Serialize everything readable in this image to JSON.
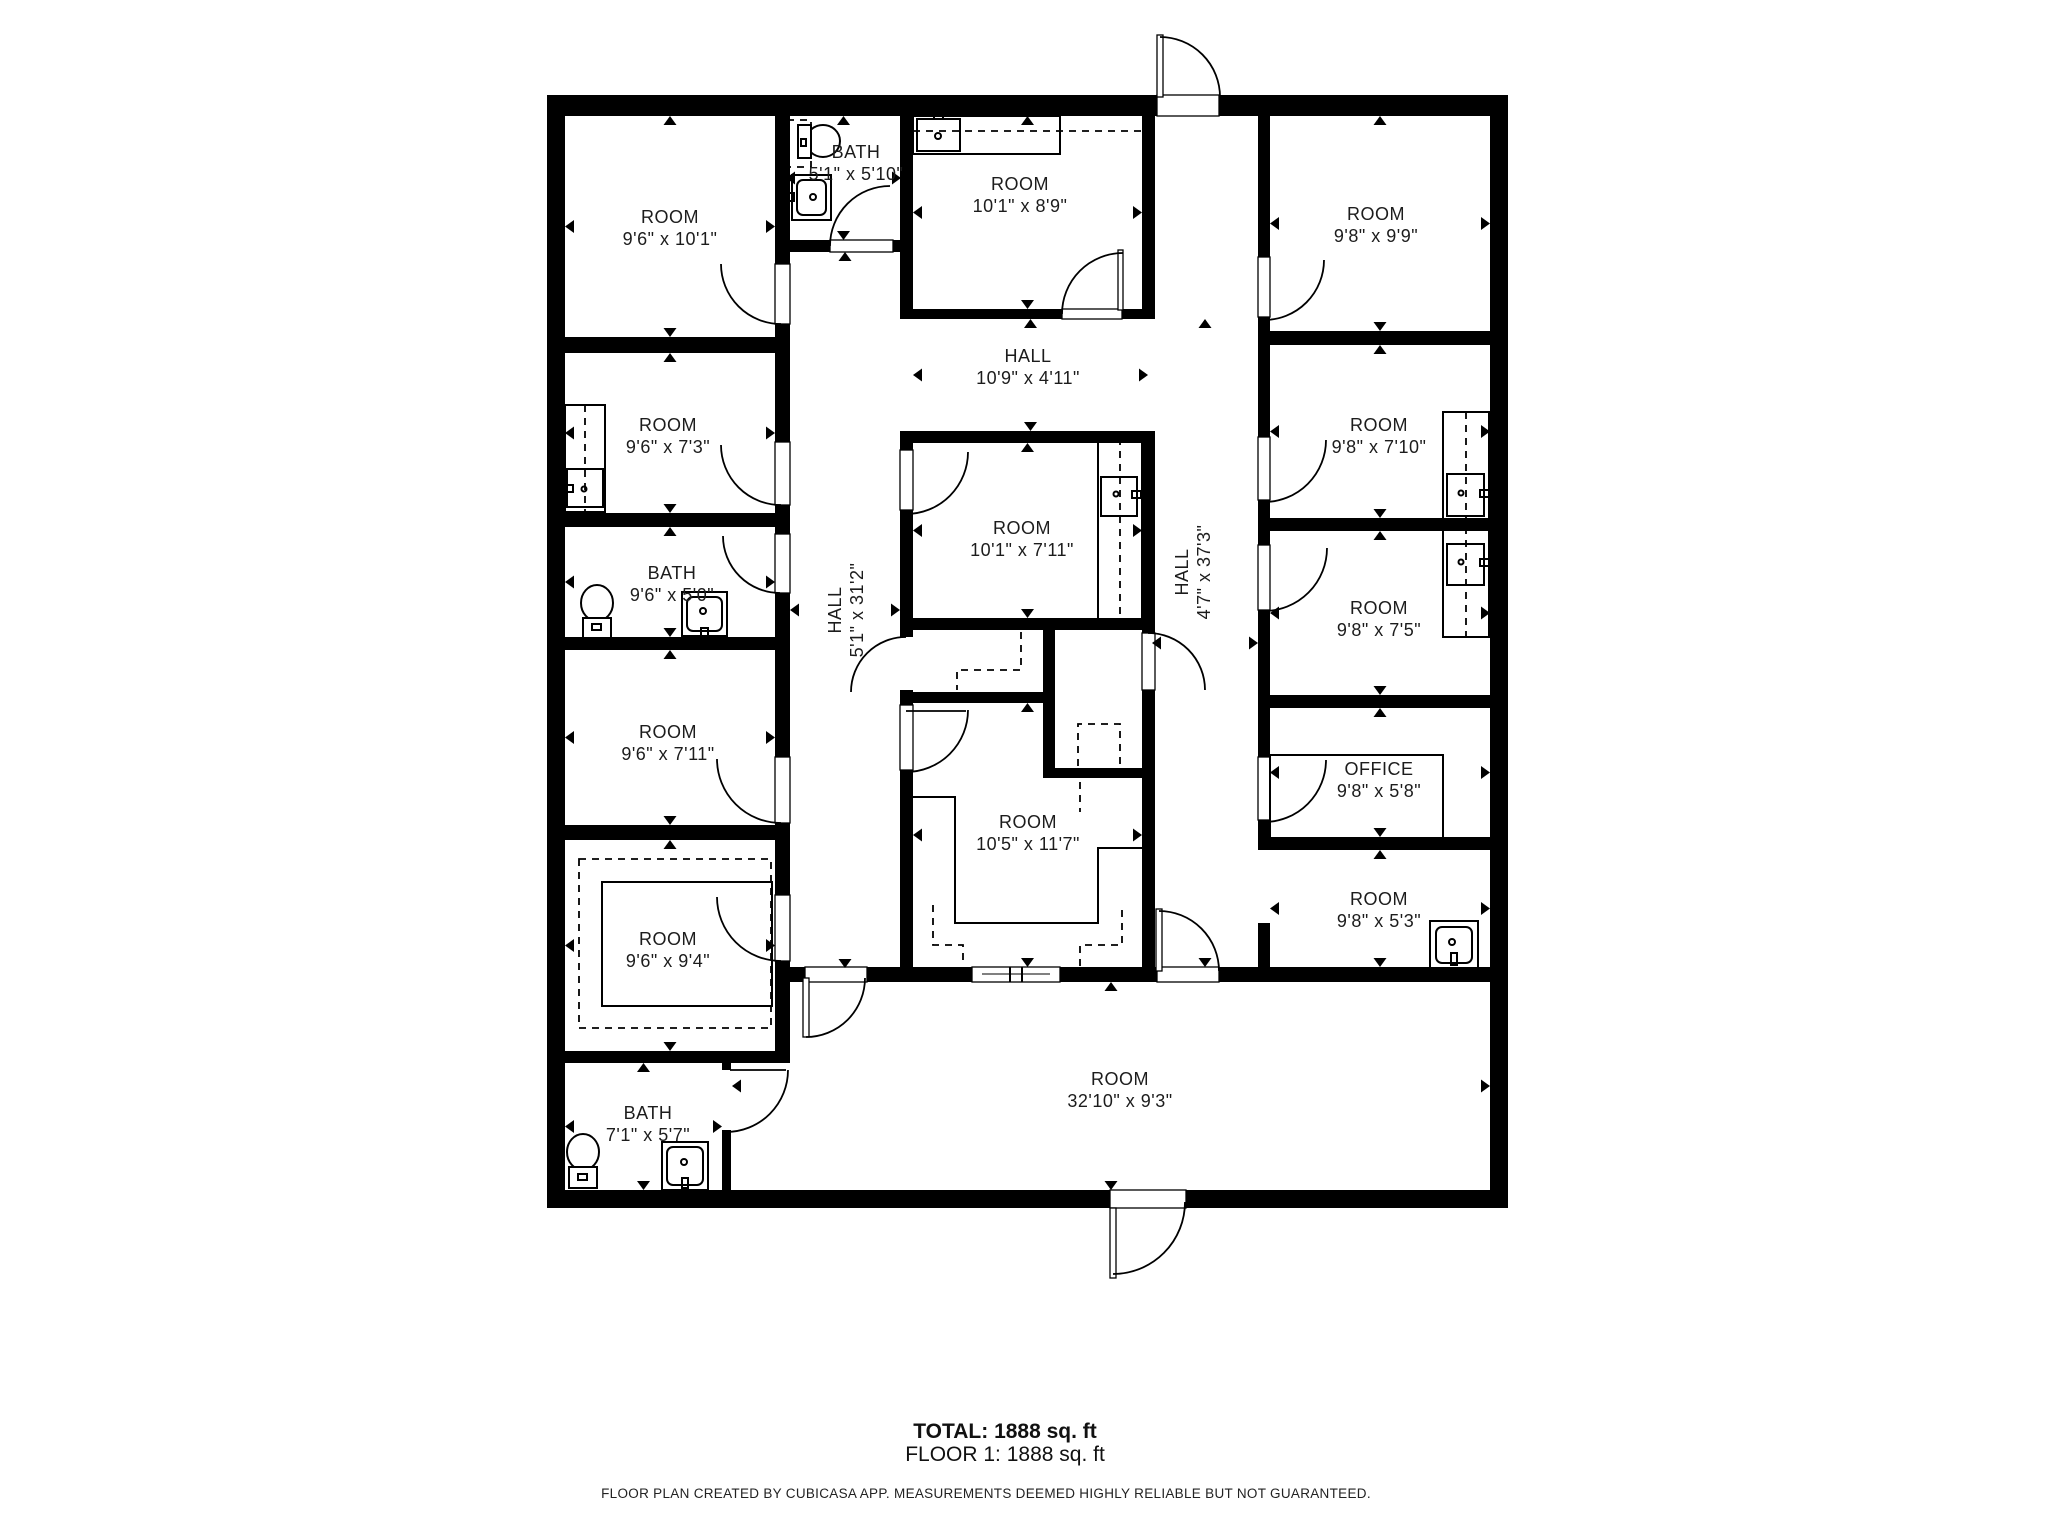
{
  "plan": {
    "rooms": [
      {
        "name": "ROOM",
        "dims": "9'6\" x 10'1\""
      },
      {
        "name": "BATH",
        "dims": "5'1\" x 5'10\""
      },
      {
        "name": "ROOM",
        "dims": "10'1\" x 8'9\""
      },
      {
        "name": "ROOM",
        "dims": "9'8\" x 9'9\""
      },
      {
        "name": "HALL",
        "dims": "10'9\" x 4'11\""
      },
      {
        "name": "ROOM",
        "dims": "9'6\" x 7'3\""
      },
      {
        "name": "HALL",
        "dims": "5'1\" x 31'2\""
      },
      {
        "name": "BATH",
        "dims": "9'6\" x 5'0\""
      },
      {
        "name": "ROOM",
        "dims": "9'6\" x 7'11\""
      },
      {
        "name": "ROOM",
        "dims": "10'1\" x 7'11\""
      },
      {
        "name": "HALL",
        "dims": "4'7\" x 37'3\""
      },
      {
        "name": "ROOM",
        "dims": "9'6\" x 9'4\""
      },
      {
        "name": "ROOM",
        "dims": "10'5\" x 11'7\""
      },
      {
        "name": "ROOM",
        "dims": "9'8\" x 7'10\""
      },
      {
        "name": "ROOM",
        "dims": "9'8\" x 7'5\""
      },
      {
        "name": "OFFICE",
        "dims": "9'8\" x 5'8\""
      },
      {
        "name": "ROOM",
        "dims": "9'8\" x 5'3\""
      },
      {
        "name": "BATH",
        "dims": "7'1\" x 5'7\""
      },
      {
        "name": "ROOM",
        "dims": "32'10\" x 9'3\""
      }
    ],
    "summary": {
      "total": "TOTAL: 1888 sq. ft",
      "floor": "FLOOR 1: 1888 sq. ft"
    },
    "disclaimer": "FLOOR PLAN CREATED BY CUBICASA APP. MEASUREMENTS DEEMED HIGHLY RELIABLE BUT NOT GUARANTEED.",
    "colors": {
      "wall": "#000000",
      "text": "#1c1c1c",
      "background": "#ffffff"
    }
  }
}
